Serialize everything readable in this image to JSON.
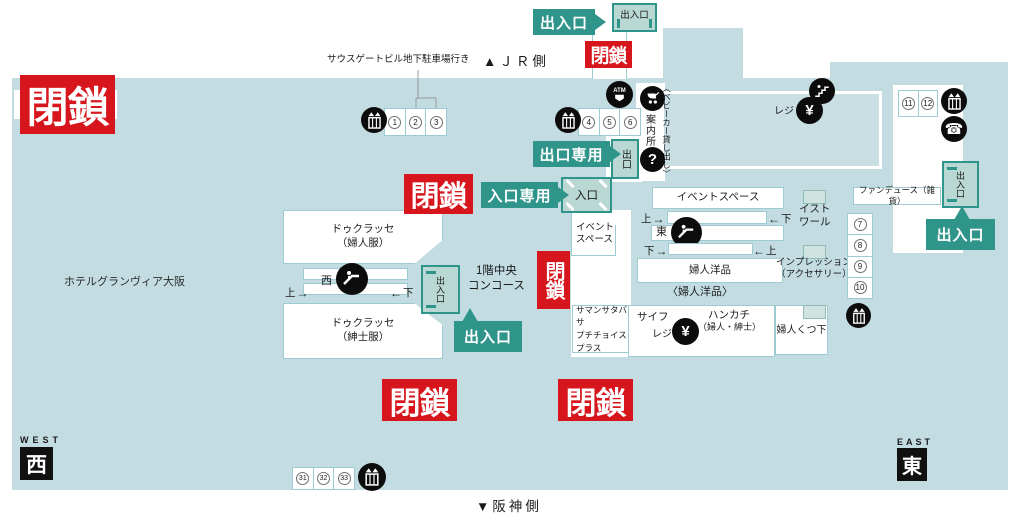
{
  "orientation": {
    "jr_side": "▲ＪＲ側",
    "hanshin_side": "▼阪神側",
    "west_en": "WEST",
    "west_ja": "西",
    "east_en": "EAST",
    "east_ja": "東"
  },
  "annotations": {
    "southgate": "サウスゲートビル地下駐車場行き",
    "hotel": "ホテルグランヴィア大阪",
    "concourse_l1": "1階中央",
    "concourse_l2": "コンコース"
  },
  "closed": {
    "text": "閉鎖"
  },
  "gates": {
    "doorway": "出入口",
    "exit_only": "出口専用",
    "entrance_only": "入口専用",
    "exit": "出口",
    "entrance": "入口"
  },
  "shops": {
    "du_classe_women_l1": "ドゥクラッセ",
    "du_classe_women_l2": "（婦人服）",
    "du_classe_men_l1": "ドゥクラッセ",
    "du_classe_men_l2": "（紳士服）",
    "event_space": "イベントスペース",
    "event_space_small_l1": "イベント",
    "event_space_small_l2": "スペース",
    "fujin_yohin": "婦人洋品",
    "fujin_yohin_note": "〈婦人洋品〉",
    "samantha_l1": "サマンサタバサ",
    "samantha_l2": "プチチョイス",
    "samantha_l3": "プラス",
    "saifu": "サイフ",
    "register": "レジ",
    "register_top": "レジ",
    "handkerchief_l1": "ハンカチ",
    "handkerchief_l2": "（婦人・紳士）",
    "fujin_kutsushita": "婦人くつ下",
    "fondue": "ファンデュース（雑貨）",
    "histoire_l1": "イスト",
    "histoire_l2": "ワール",
    "impression_l1": "インプレッション",
    "impression_l2": "（アクセサリー）"
  },
  "services": {
    "info": "案内所",
    "stroller_note": "〈ベビーカー貸し出し〉",
    "question": "?",
    "yen": "¥",
    "atm": "ATM",
    "phone": "☎"
  },
  "escalators": {
    "west": {
      "kanji": "西",
      "up": "上",
      "down": "下",
      "arrow_right": "→",
      "arrow_left": "←"
    },
    "east": {
      "kanji": "東",
      "up": "上",
      "down": "下",
      "arrow_right": "→",
      "arrow_left": "←"
    }
  },
  "numbers": {
    "g123": [
      "1",
      "2",
      "3"
    ],
    "g456": [
      "4",
      "5",
      "6"
    ],
    "g78910": [
      "7",
      "8",
      "9",
      "10"
    ],
    "g1112": [
      "11",
      "12"
    ],
    "g313233": [
      "31",
      "32",
      "33"
    ]
  }
}
